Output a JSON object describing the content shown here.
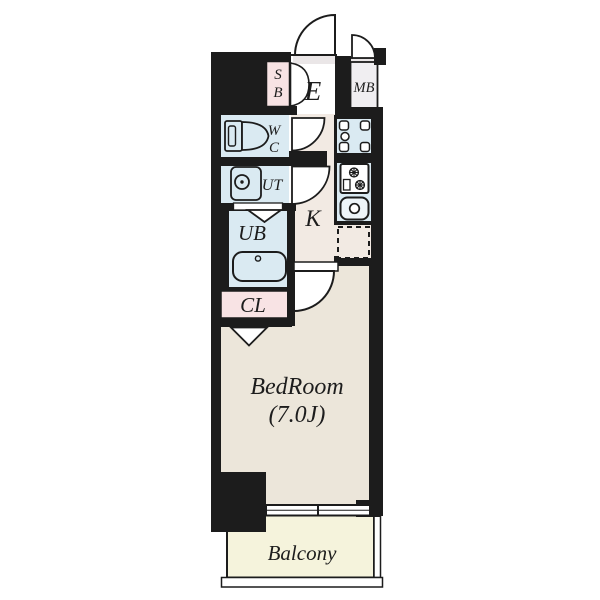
{
  "plan": {
    "type": "apartment-floor-plan",
    "rooms": {
      "shoe_box_l1": "S",
      "shoe_box_l2": "B",
      "entrance": "E",
      "meter_box": "MB",
      "wc_l1": "W",
      "wc_l2": "C",
      "utility": "UT",
      "unit_bath": "UB",
      "closet": "CL",
      "kitchen": "K",
      "bedroom_l1": "BedRoom",
      "bedroom_l2": "(7.0J)",
      "balcony": "Balcony"
    },
    "palette": {
      "wall_black": "#1c1c1c",
      "wet_area_blue": "#daeaf2",
      "storage_pink": "#f8e3e4",
      "hall_beige": "#f2eae3",
      "bedroom_beige": "#ece6da",
      "balcony_yellow": "#f5f3dc",
      "meter_box_gray": "#f0eef1",
      "threshold_gray": "#eae6e7"
    }
  }
}
